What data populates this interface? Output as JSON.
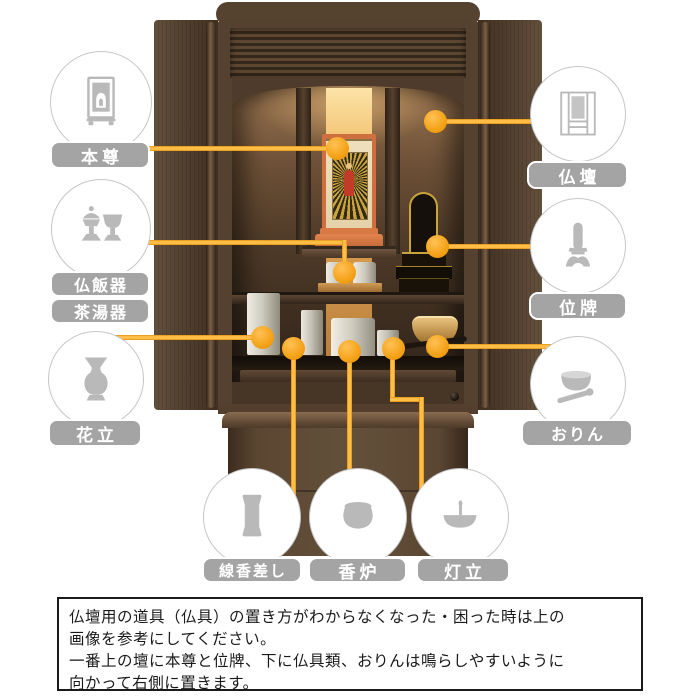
{
  "colors": {
    "accent_line": "#F5A11C",
    "accent_line_edge": "#E18F0C",
    "label_bg": "#A4A4A4",
    "label_text": "#FFFFFF",
    "circle_border": "#C6C6C6",
    "icon_gray": "#B9B9B9",
    "wood_dark": "#53402F",
    "gold_backdrop": "#E2A859",
    "scroll_stand_orange": "#CF6F3F"
  },
  "callouts": {
    "honzon": {
      "label": "本尊",
      "icon": "hanging-scroll"
    },
    "butsudan": {
      "label": "仏壇",
      "icon": "altar-cabinet"
    },
    "butsuhanki": {
      "label": "仏飯器",
      "icon": "offering-vessels"
    },
    "chatouki": {
      "label": "茶湯器",
      "icon": "offering-vessels"
    },
    "ihai": {
      "label": "位牌",
      "icon": "memorial-tablet"
    },
    "hanatate": {
      "label": "花立",
      "icon": "flower-vase"
    },
    "orin": {
      "label": "おりん",
      "icon": "orin-bell"
    },
    "senkosashi": {
      "label": "線香差し",
      "icon": "incense-stick-holder"
    },
    "koro": {
      "label": "香炉",
      "icon": "incense-burner"
    },
    "todate": {
      "label": "灯立",
      "icon": "candle-stand"
    }
  },
  "note": {
    "text": "仏壇用の道具（仏具）の置き方がわからなくなった・困った時は上の\n画像を参考にしてください。\n一番上の壇に本尊と位牌、下に仏具類、おりんは鳴らしやすいように\n向かって右側に置きます。"
  }
}
